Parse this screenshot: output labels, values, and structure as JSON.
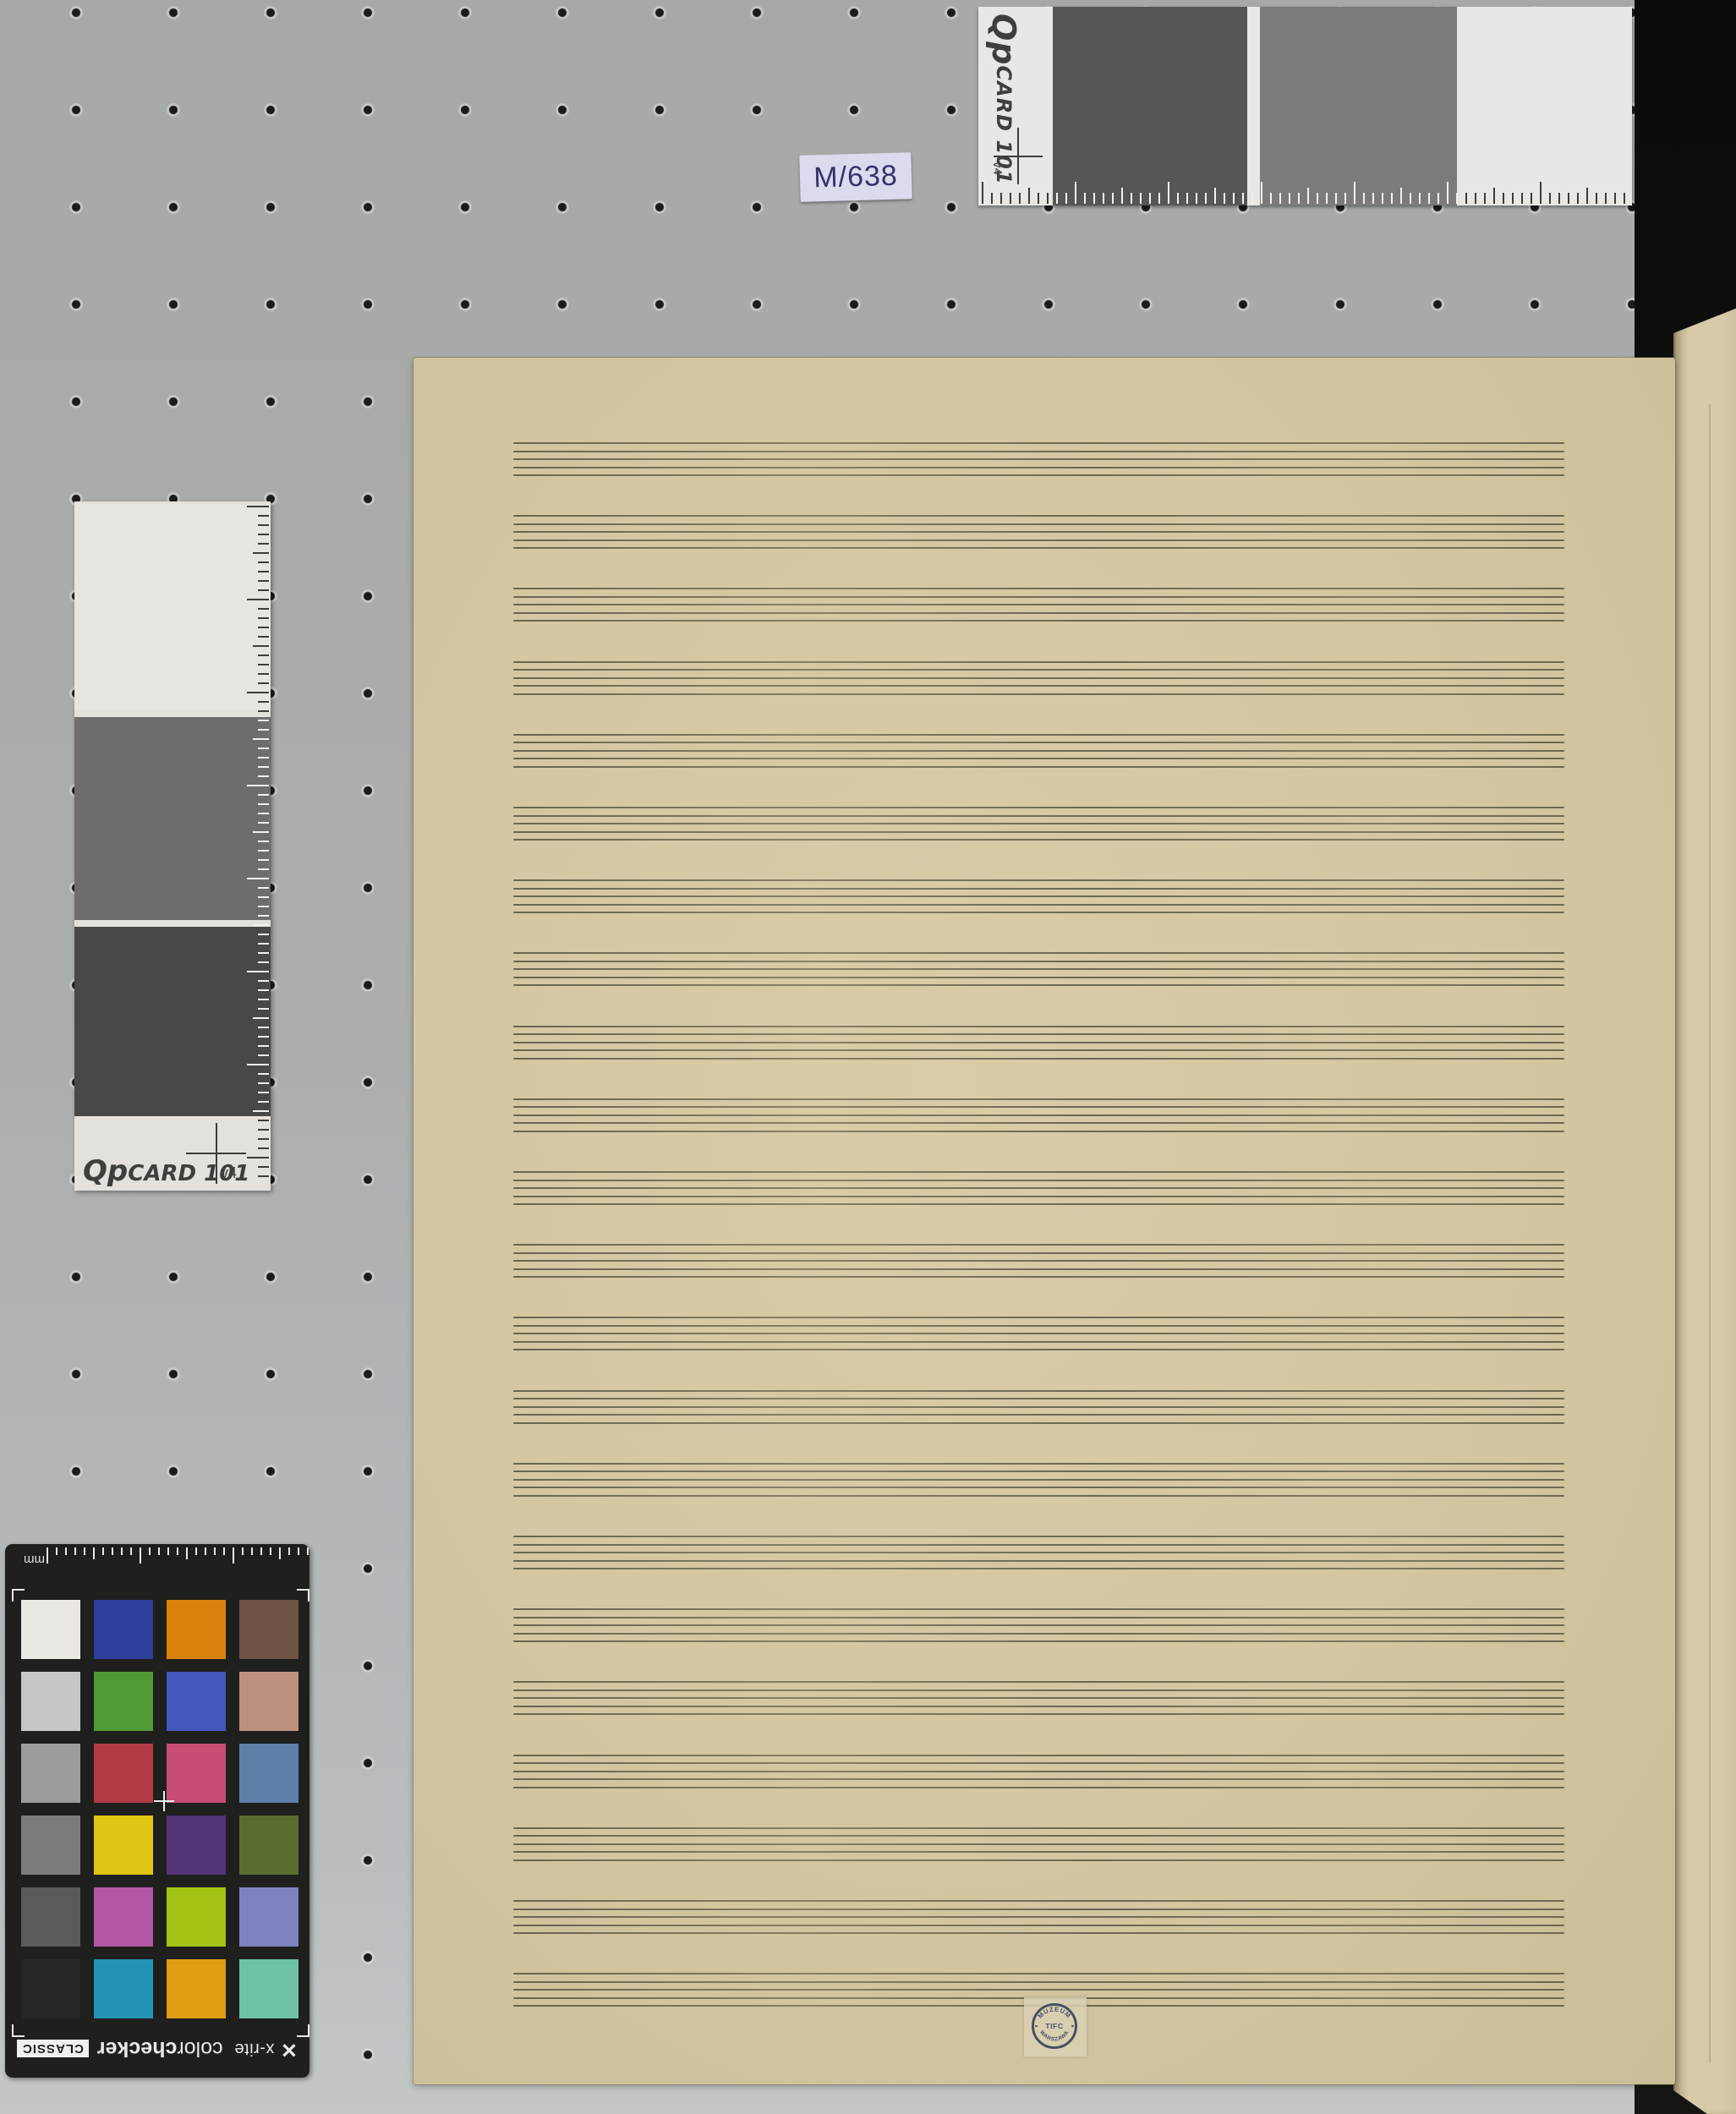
{
  "scene": {
    "board_color_top": "#a6a9a8",
    "board_color_bottom": "#c3c7c6",
    "dot_color": "#1b1b1b",
    "backdrop_color": "#0c0c0c"
  },
  "shelf_label": {
    "text": "M/638"
  },
  "qp_card_top": {
    "brand": "Qp",
    "model": "CARD 101",
    "version": "v4"
  },
  "qp_card_left": {
    "brand": "Qp",
    "model": "CARD 101",
    "version": "v4"
  },
  "colorchecker": {
    "unit": "mm",
    "brand": "x-rite",
    "title_light": "color",
    "title_bold": "checker",
    "variant": "CLASSIC",
    "patches": [
      "#e9e8e3",
      "#2e3e9c",
      "#d8820d",
      "#6e5243",
      "#c6c6c4",
      "#4f9a34",
      "#4558bf",
      "#bd917e",
      "#9c9c9a",
      "#b13a44",
      "#c94d72",
      "#5c80a7",
      "#7b7b79",
      "#e0c513",
      "#523478",
      "#5b6c30",
      "#595b5a",
      "#b557a4",
      "#a3c414",
      "#7e83bf",
      "#252726",
      "#2394b5",
      "#df9d11",
      "#6dc3a2"
    ]
  },
  "manuscript": {
    "paper_color": "#d3c7a3",
    "staff_line_color": "#5d5a44",
    "staff_count": 22,
    "lines_per_staff": 5,
    "stamp": {
      "top_text": "MUZEUM",
      "bottom_text": "WARSZAWA",
      "center_text": "TIFC"
    }
  }
}
